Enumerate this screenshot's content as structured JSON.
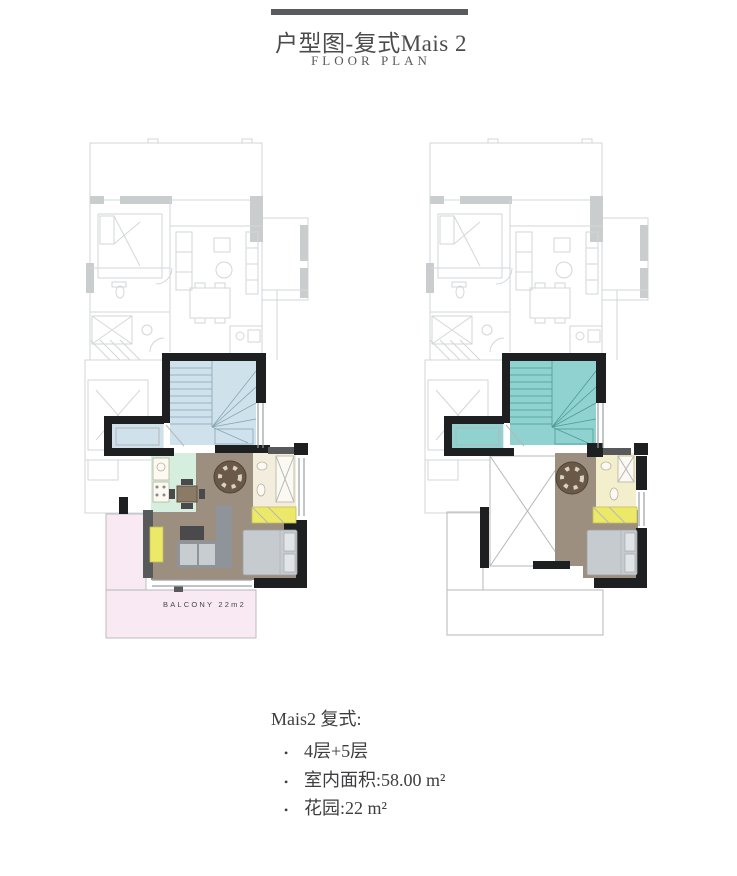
{
  "header": {
    "title": "户型图-复式Mais 2",
    "subtitle": "FLOOR PLAN"
  },
  "plans": {
    "left": {
      "name": "mais2-lower-level-plan",
      "balcony_label": "BALCONY 22m2"
    },
    "right": {
      "name": "mais2-upper-level-plan"
    }
  },
  "notes": {
    "title": "Mais2 复式:",
    "bullet": "•",
    "items": [
      "4层+5层",
      "室内面积:58.00 m²",
      "花园:22 m²"
    ]
  },
  "colors": {
    "bar": "#5a5b5d",
    "walls": "#1e1f21",
    "wall-gray": "#58595b",
    "faded": "#d3d6d8",
    "faded-fill": "#c9cdce",
    "stairs-left": "#cfe1ea",
    "stairs-right": "#8fd2cf",
    "stair-lines-left": "#87a7b8",
    "stair-lines-right": "#4f9a97",
    "floor": "#9d8f80",
    "kitchen": "#d5eedd",
    "bath-left": "#f2eddc",
    "bath-right": "#f3eecb",
    "accent-yellow": "#ece968",
    "balcony-pink": "#f8e9f2",
    "bed": "#c6cbcf",
    "sofa": "#8e9499",
    "text": "#3e3e40"
  }
}
